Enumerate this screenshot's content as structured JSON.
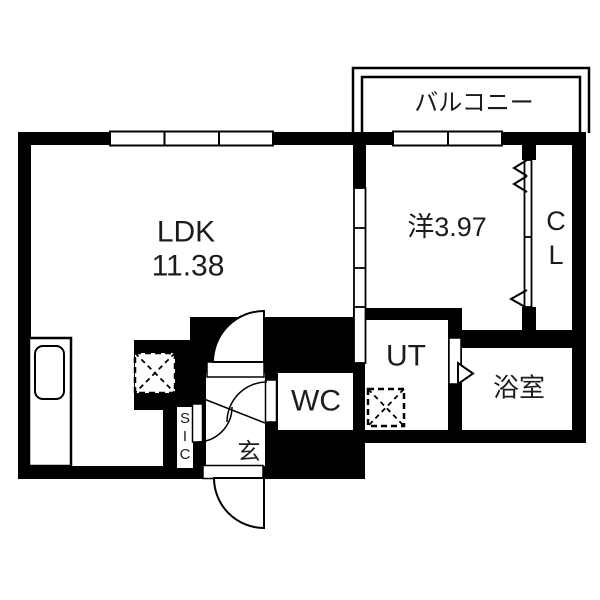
{
  "plan": {
    "canvas": {
      "width": 600,
      "height": 600,
      "wall_color": "#000000",
      "floor_color": "#ffffff",
      "text_color": "#1c1c1c"
    },
    "rooms": {
      "balcony": {
        "label": "バルコニー"
      },
      "ldk": {
        "name": "LDK",
        "area": "11.38"
      },
      "western": {
        "label": "洋3.97"
      },
      "closet": {
        "char1": "C",
        "char2": "L"
      },
      "utility": {
        "label": "UT"
      },
      "toilet": {
        "label": "WC"
      },
      "bath": {
        "label": "浴室"
      },
      "shoe_closet": {
        "char1": "S",
        "char2": "I",
        "char3": "C"
      },
      "entrance": {
        "label": "玄"
      }
    }
  }
}
